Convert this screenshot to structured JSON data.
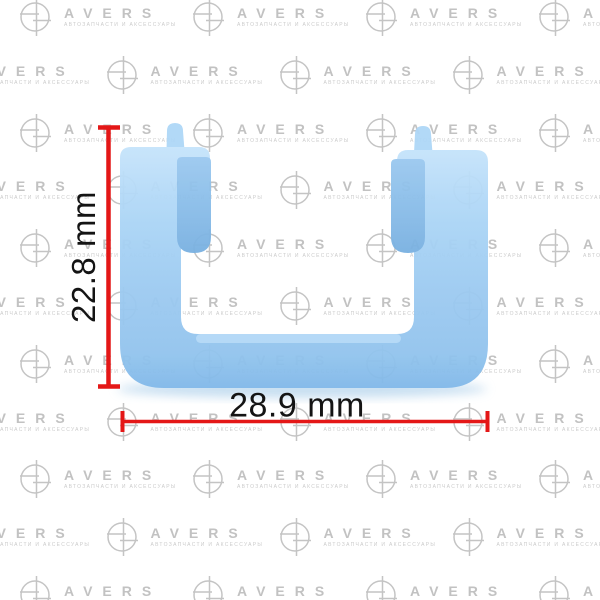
{
  "image": {
    "background_color": "#ffffff"
  },
  "watermark": {
    "brand": "AVERS",
    "caption": "АВТОЗАПЧАСТИ И АКСЕССУАРЫ",
    "color": "#c2c2c2",
    "grid": {
      "first_row_y": 17,
      "row_spacing": 57.8,
      "rows": 11,
      "col_spacing": 173,
      "first_logo_x": 35,
      "odd_row_offset": -86.5
    }
  },
  "clip": {
    "body_highlight_color": "#c6e4fb",
    "body_color": "#a3d0f3",
    "body_shadow_color": "#7fb7e8",
    "tab_color": "#82b8e4"
  },
  "dimensions": {
    "line_color": "#e41717",
    "text_color": "#141414",
    "vertical": {
      "label": "22.8 mm"
    },
    "horizontal": {
      "label": "28.9 mm"
    }
  }
}
